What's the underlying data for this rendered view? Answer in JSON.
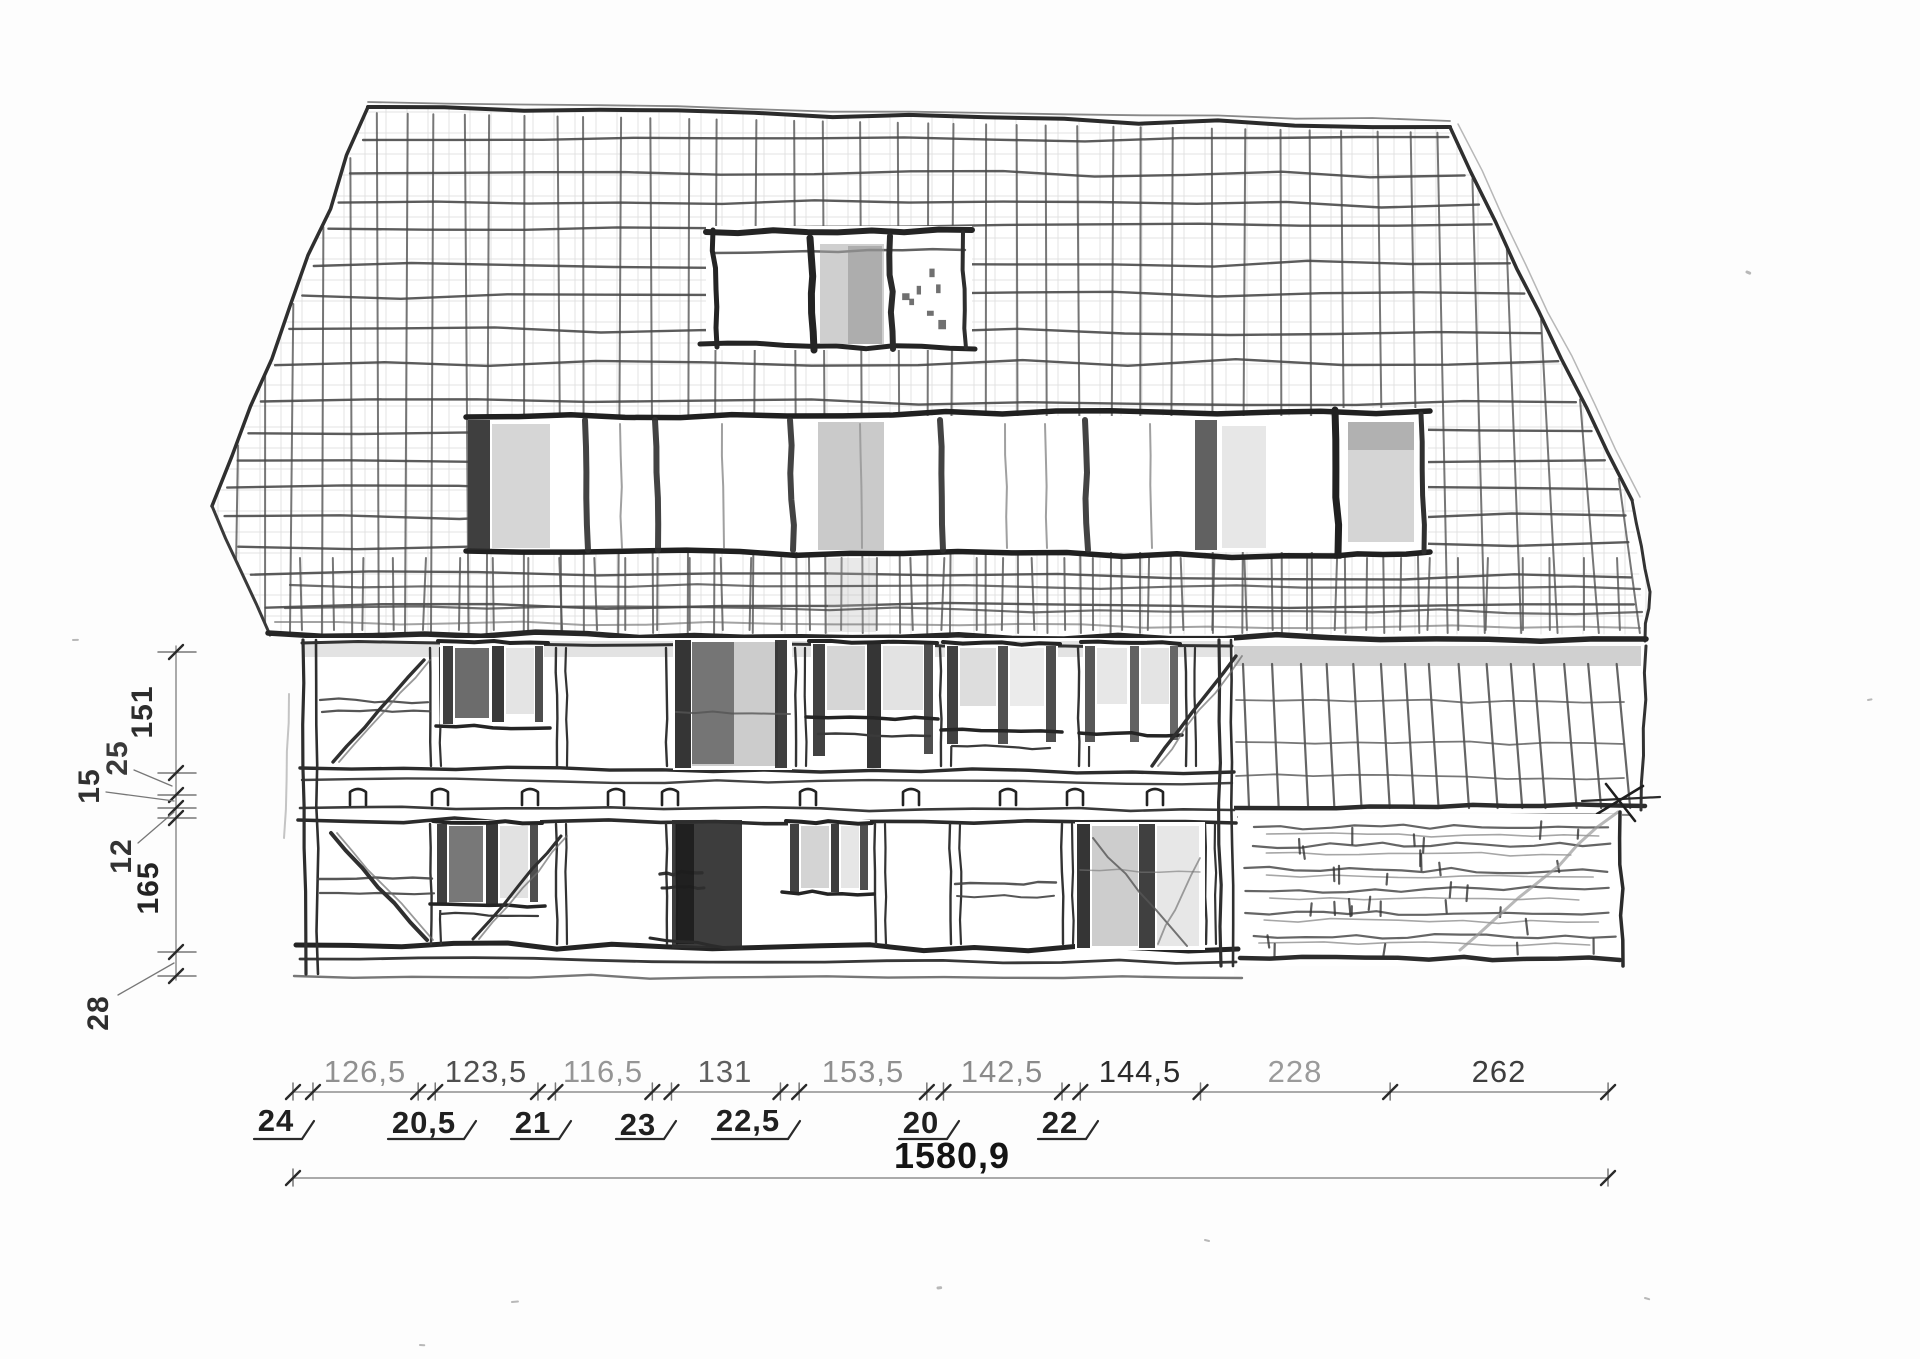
{
  "drawing": {
    "subject": "hand-drawn-house-facade-elevation-sketch"
  },
  "dimensions": {
    "vertical_chain": {
      "labels": [
        "151",
        "25",
        "15",
        "12",
        "165",
        "28"
      ]
    },
    "horizontal_chain": {
      "bay_widths": [
        "126,5",
        "123,5",
        "116,5",
        "131",
        "153,5",
        "142,5",
        "144,5",
        "228",
        "262"
      ],
      "post_widths": [
        "24",
        "20,5",
        "21",
        "23",
        "22,5",
        "20",
        "22"
      ]
    },
    "total_width": "1580,9"
  },
  "colors": {
    "ink": "#2b2b2b",
    "pencil": "#4a4a4a",
    "faded_label": "#8d8d8d",
    "dark_label": "#1f1f1f",
    "paper": "#fdfdfd"
  }
}
